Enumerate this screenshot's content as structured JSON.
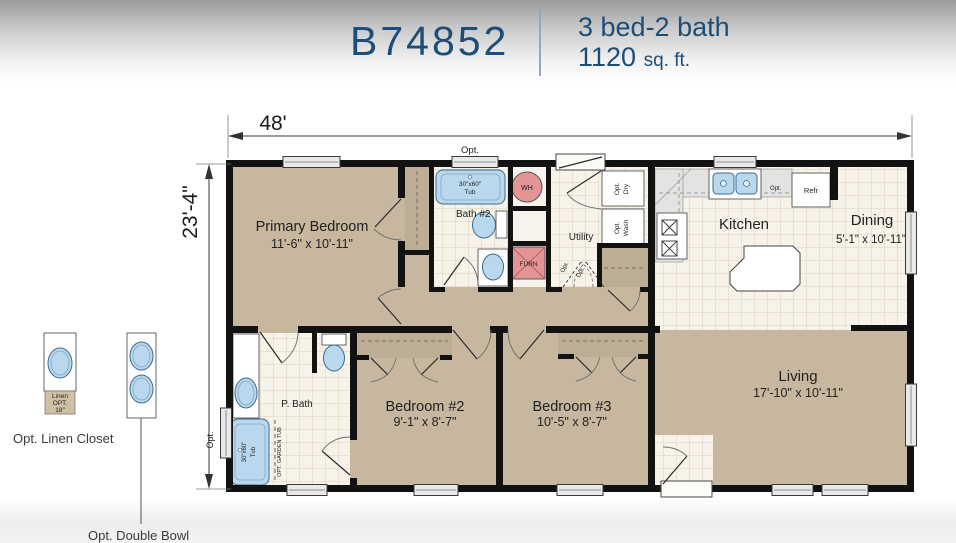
{
  "header": {
    "model": "B74852",
    "beds_baths": "3 bed-2 bath",
    "sqft": "1120",
    "sqft_unit": "sq. ft.",
    "accent_color": "#1d4e79"
  },
  "dimensions": {
    "width": "48'",
    "depth": "23'-4\""
  },
  "rooms": {
    "primary": {
      "name": "Primary Bedroom",
      "size": "11'-6\" x 10'-11\""
    },
    "bath2": {
      "name": "Bath #2"
    },
    "utility": {
      "name": "Utility"
    },
    "kitchen": {
      "name": "Kitchen"
    },
    "dining": {
      "name": "Dining",
      "size": "5'-1\" x 10'-11\""
    },
    "pbath": {
      "name": "P. Bath"
    },
    "bedroom2": {
      "name": "Bedroom #2",
      "size": "9'-1\" x 8'-7\""
    },
    "bedroom3": {
      "name": "Bedroom #3",
      "size": "10'-5\" x 8'-7\""
    },
    "living": {
      "name": "Living",
      "size": "17'-10\" x 10'-11\""
    }
  },
  "fixtures": {
    "tub_size": "30\"x60\"",
    "tub_word": "Tub",
    "water_heater": "WH",
    "furnace": "FURN",
    "opt": "Opt.",
    "dry": "Dry",
    "wash": "Wash",
    "refrigerator": "Refr",
    "garden_tub": "OPT. GARDEN TUB",
    "linen_line1": "Linen",
    "linen_line2": "OPT.",
    "linen_line3": "18\""
  },
  "annotations": {
    "opt": "Opt.",
    "linen_caption": "Opt. Linen Closet",
    "double_bowl_caption": "Opt. Double Bowl"
  },
  "colors": {
    "accent": "#1d4e79",
    "carpet": "#c6b79e",
    "closet": "#bcae94",
    "tile": "#f7f3e9",
    "fixture_blue": "#b9d8ee",
    "mech_pink": "#e49494"
  }
}
